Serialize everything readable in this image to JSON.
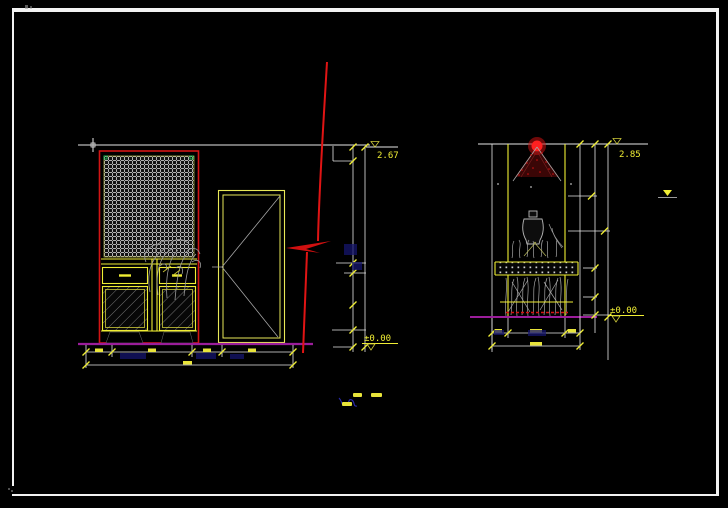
{
  "palette": {
    "background": "#000000",
    "window_frame": "#f2f2f2",
    "line_white": "#e6e6e6",
    "line_yellow": "#f0ee34",
    "line_red": "#dd1414",
    "line_magenta": "#9b1d9b",
    "line_gray": "#a6a6a6",
    "snap_green": "#1db954",
    "selection_blue": "#15156e"
  },
  "left_elevation": {
    "levels": {
      "top": "2.67",
      "floor": "±0.00"
    }
  },
  "right_elevation": {
    "levels": {
      "top": "2.85",
      "floor": "±0.00"
    }
  }
}
